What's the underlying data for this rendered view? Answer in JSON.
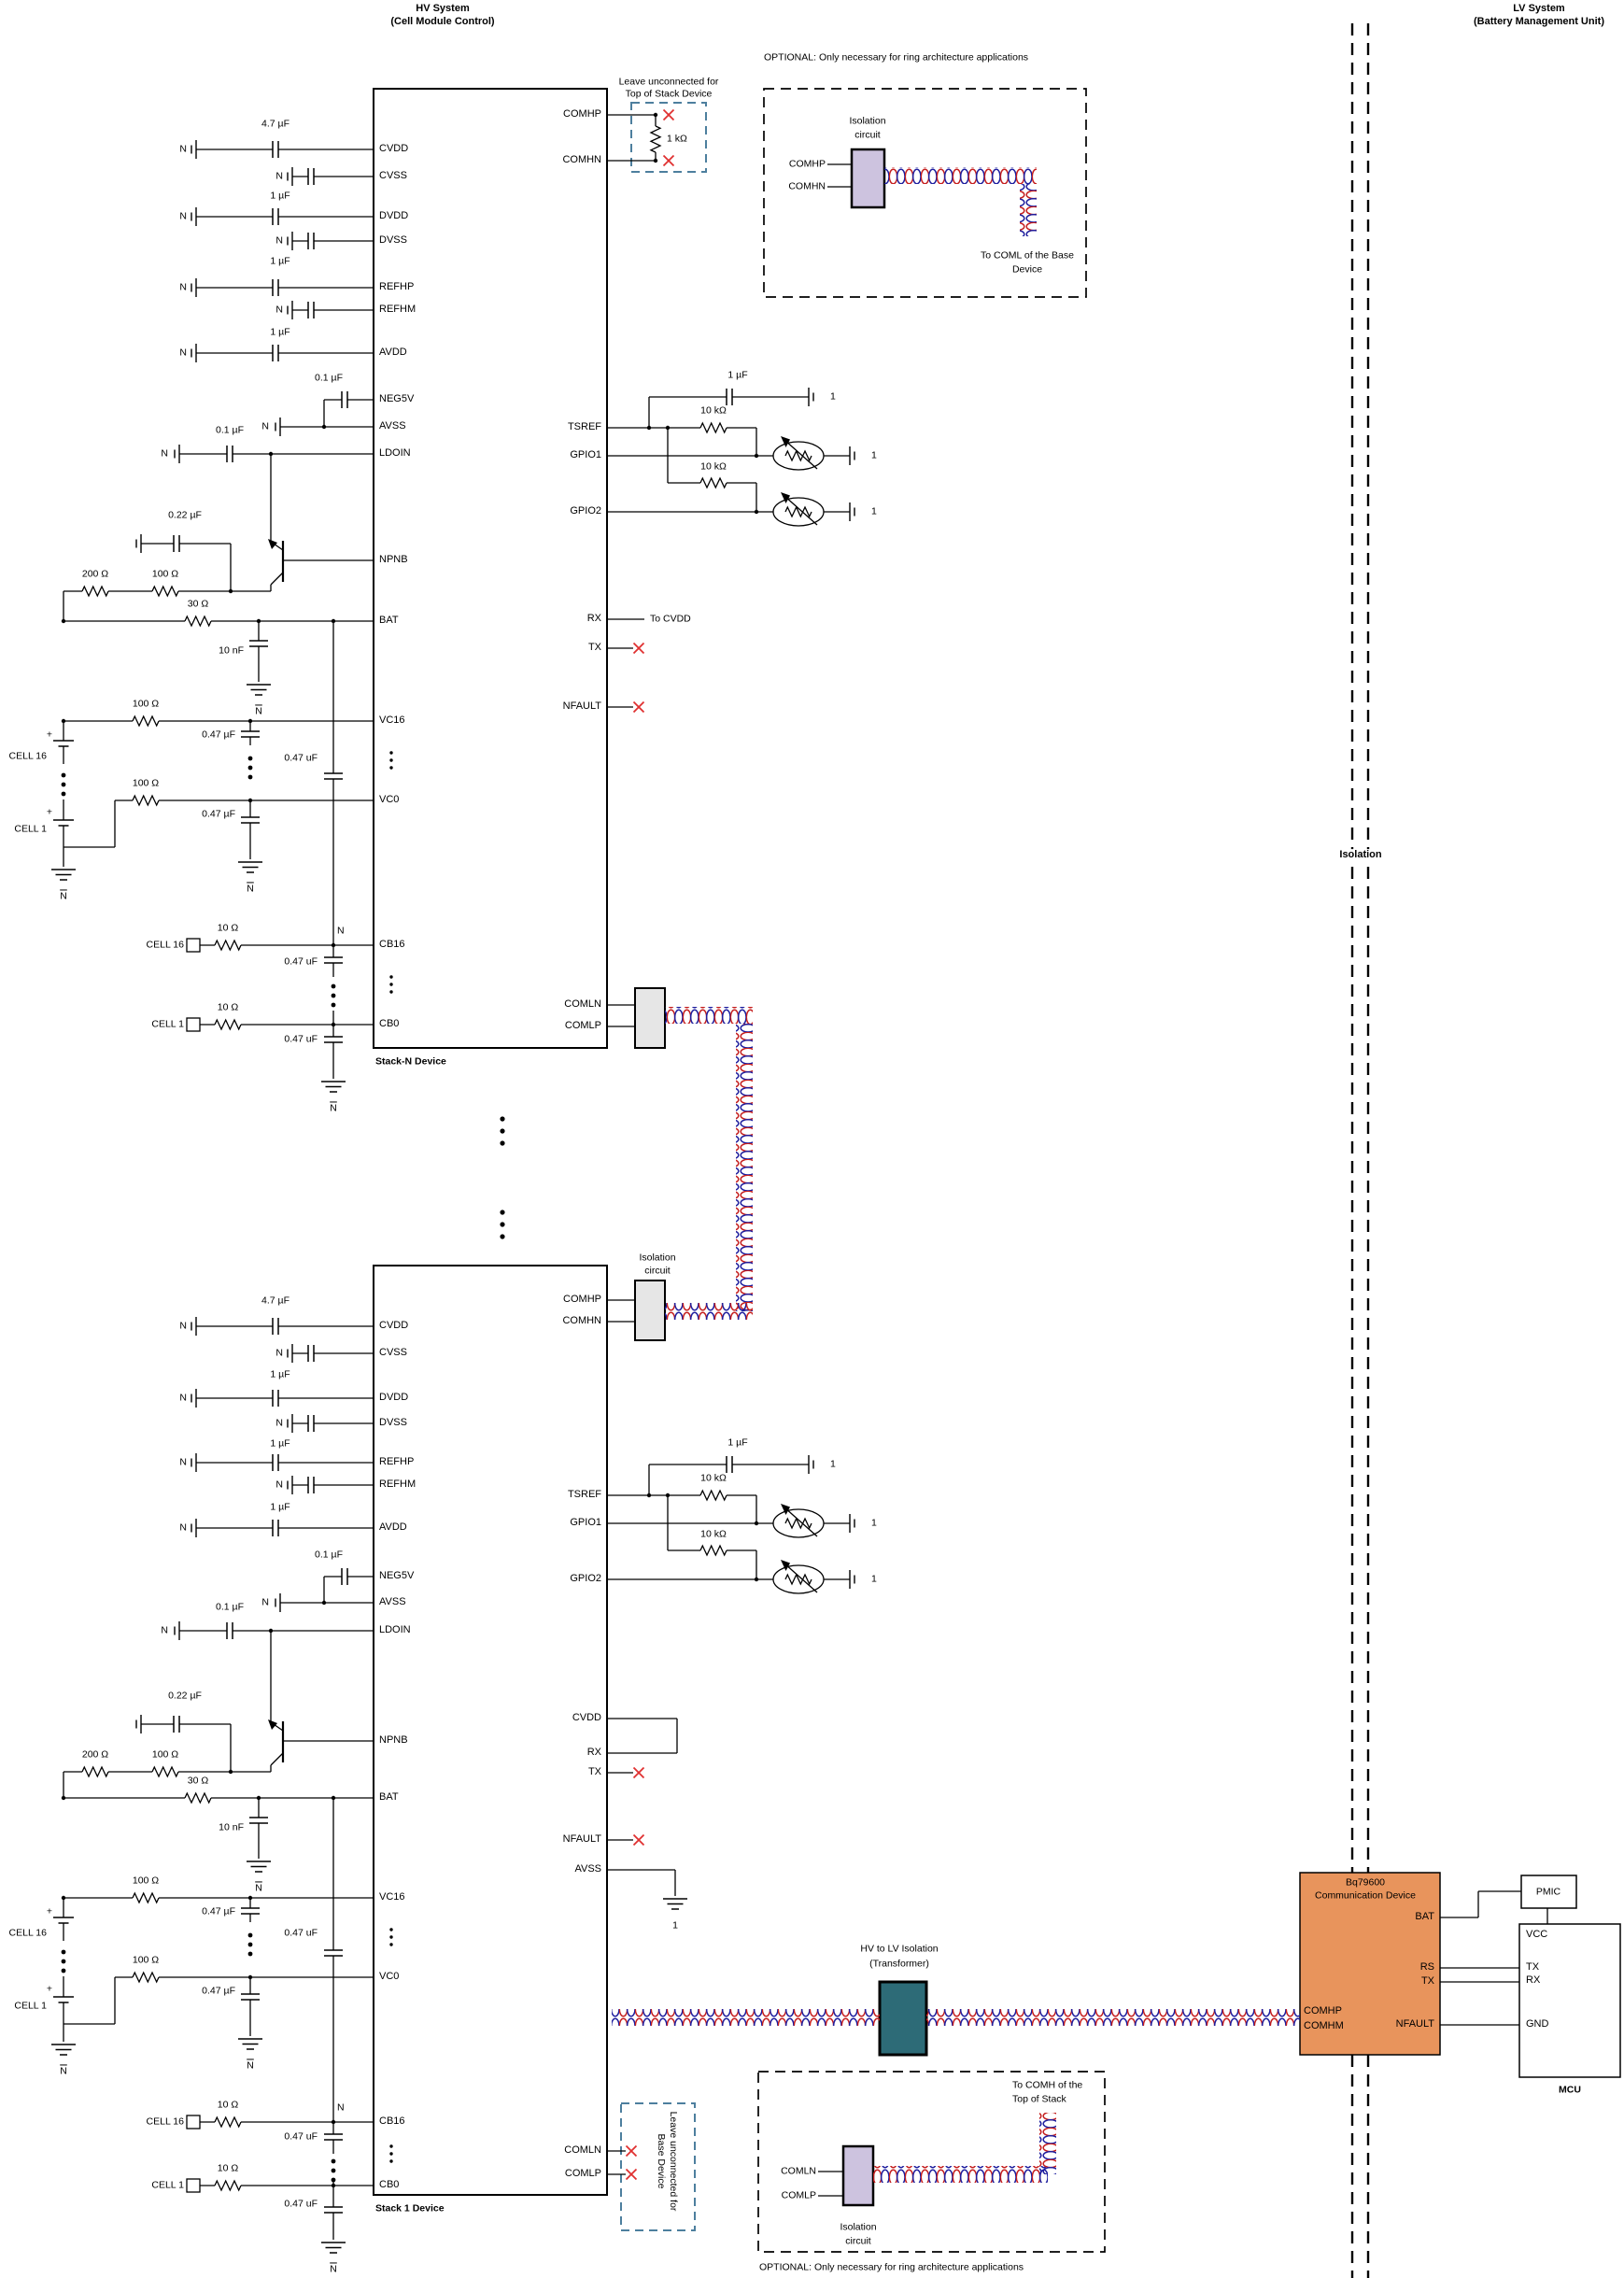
{
  "headers": {
    "hv_title": "HV System",
    "hv_sub": "(Cell Module Control)",
    "lv_title": "LV System",
    "lv_sub": "(Battery Management Unit)",
    "isolation": "Isolation"
  },
  "pin": {
    "cvdd": "CVDD",
    "cvss": "CVSS",
    "dvdd": "DVDD",
    "dvss": "DVSS",
    "refhp": "REFHP",
    "refhm": "REFHM",
    "avdd": "AVDD",
    "neg5v": "NEG5V",
    "avss": "AVSS",
    "ldoin": "LDOIN",
    "npnb": "NPNB",
    "bat": "BAT",
    "vc16": "VC16",
    "vc0": "VC0",
    "cb16": "CB16",
    "cb0": "CB0",
    "comhp": "COMHP",
    "comhn": "COMHN",
    "comhm": "COMHM",
    "comln": "COMLN",
    "comlp": "COMLP",
    "tsref": "TSREF",
    "gpio1": "GPIO1",
    "gpio2": "GPIO2",
    "rx": "RX",
    "tx": "TX",
    "nfault": "NFAULT",
    "vcc": "VCC",
    "gnd": "GND",
    "rs": "RS"
  },
  "val": {
    "c_4u7": "4.7 µF",
    "c_1u": "1 µF",
    "c_0u1": "0.1 µF",
    "c_0u22": "0.22 µF",
    "c_10n": "10 nF",
    "c_0u47": "0.47 µF",
    "c_0u47_alt": "0.47 uF",
    "r_200": "200 Ω",
    "r_100": "100 Ω",
    "r_30": "30 Ω",
    "r_10": "10 Ω",
    "r_1k": "1 kΩ",
    "r_10k": "10 kΩ",
    "gnd_n": "N",
    "gnd_1": "1",
    "plus": "+",
    "cell16": "CELL 16",
    "cell1": "CELL 1"
  },
  "devices": {
    "stack_n": "Stack-N Device",
    "stack_1": "Stack 1 Device",
    "bq_line1": "Bq79600",
    "bq_line2": "Communication Device",
    "pmic": "PMIC",
    "mcu": "MCU"
  },
  "notes": {
    "to_cvdd": "To CVDD",
    "leave_top_1": "Leave unconnected for",
    "leave_top_2": "Top of Stack Device",
    "leave_base_1": "Leave unconnected for",
    "leave_base_2": "Base Device",
    "optional": "OPTIONAL",
    "optional_rest": ": Only necessary for ring architecture applications",
    "iso_circ_1": "Isolation",
    "iso_circ_2": "circuit",
    "to_coml_1": "To COML of the Base",
    "to_coml_2": "Device",
    "to_comh_1": "To COMH of the",
    "to_comh_2": "Top of Stack",
    "hvlv_1": "HV to LV Isolation",
    "hvlv_2": "(Transformer)"
  },
  "colors": {
    "wire": "#000000",
    "pair_red": "#c41e1e",
    "pair_blue": "#1e1e9e",
    "x_red": "#e03030",
    "dashed_blue": "#4d7f9e",
    "lavender": "#cdc3df",
    "gray_box": "#e6e6e6",
    "teal": "#2d6b77",
    "orange": "#e8945c"
  }
}
